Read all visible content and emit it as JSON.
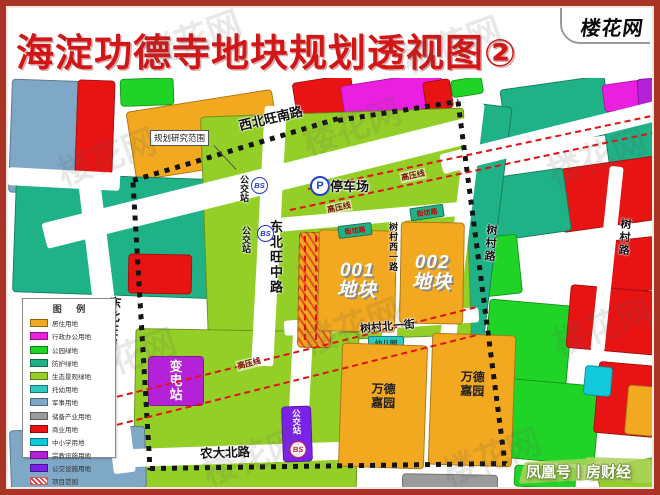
{
  "header": {
    "title": "海淀功德寺地块规划透视图②",
    "logo": "楼花网"
  },
  "legend": {
    "title": "图 例",
    "items": [
      {
        "label": "居住用地",
        "color": "#f2a81f"
      },
      {
        "label": "行政办公用地",
        "color": "#ea1fe0"
      },
      {
        "label": "公园绿地",
        "color": "#1fd426"
      },
      {
        "label": "防护绿地",
        "color": "#1fb287"
      },
      {
        "label": "生态景观绿地",
        "color": "#94cf27"
      },
      {
        "label": "托幼用地",
        "color": "#2bc9c0"
      },
      {
        "label": "军事用地",
        "color": "#7fa8c7"
      },
      {
        "label": "储备产业用地",
        "color": "#9b9b9b"
      },
      {
        "label": "商业用地",
        "color": "#e81414"
      },
      {
        "label": "中小学用地",
        "color": "#12c9da"
      },
      {
        "label": "宗教设施用地",
        "color": "#b521d8"
      },
      {
        "label": "公交设施用地",
        "color": "#7b22e8"
      },
      {
        "label": "项目范围",
        "color": "#e03030",
        "swatch": "hatch"
      },
      {
        "label": "规划研究范围",
        "color": "#141414",
        "swatch": "dash"
      }
    ]
  },
  "roads": {
    "xibeiwang_south": "西北旺南路",
    "dongbeiwang_middle": "东北旺中路",
    "dongbeiwang_west": "东北旺西路",
    "shucun": "树村路",
    "shucun_west_first": "树村西一路",
    "shucun_north_first": "树村北一街",
    "nongda_north": "农大北路"
  },
  "map_labels": {
    "research_scope": "规划研究范围",
    "parking": "停车场",
    "parking_icon": "P",
    "bus_station": "公交站",
    "bus_icon": "BS",
    "substation": "变电站",
    "plot1_no": "001",
    "plot2_no": "002",
    "plot_suffix": "地块",
    "kindergarten": "幼儿园",
    "garden": "万德嘉园",
    "power_line": "高压线",
    "neighborhood_road": "街坊路"
  },
  "watermarks": {
    "tile": "楼花网",
    "publisher": "凤凰号丨房财经"
  }
}
